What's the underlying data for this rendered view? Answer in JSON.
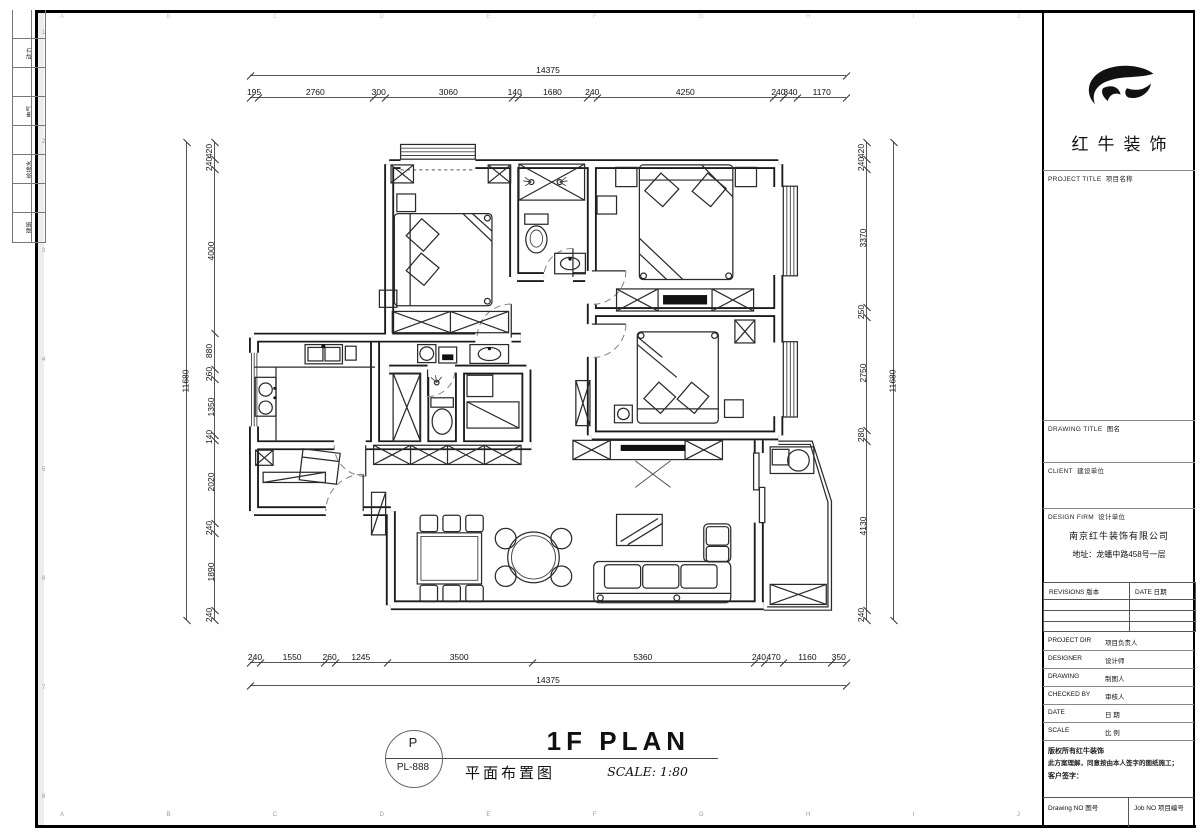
{
  "sheet": {
    "margin_rows": [
      "",
      "动力",
      "",
      "电气",
      "",
      "给排水",
      "",
      "建筑"
    ],
    "bottom_ruler_letters": [
      "A",
      "B",
      "C",
      "D",
      "E",
      "F",
      "G",
      "H",
      "I",
      "J"
    ],
    "top_ruler_letters": [
      "A",
      "B",
      "C",
      "D",
      "E",
      "F",
      "G",
      "H",
      "I",
      "J"
    ],
    "left_ruler_numbers": [
      "1",
      "2",
      "3",
      "4",
      "5",
      "6",
      "7",
      "8"
    ]
  },
  "dimensions": {
    "top": {
      "segments": [
        "195",
        "2760",
        "300",
        "3060",
        "140",
        "1680",
        "240",
        "4250",
        "240",
        "340",
        "1170"
      ],
      "total": [
        "14375"
      ]
    },
    "bottom": {
      "segments": [
        "240",
        "1550",
        "260",
        "1245",
        "3500",
        "5360",
        "240",
        "470",
        "1160",
        "350"
      ],
      "total": [
        "14375"
      ]
    },
    "left": {
      "segments": [
        "420",
        "240",
        "4000",
        "880",
        "260",
        "1350",
        "140",
        "2020",
        "240",
        "1890",
        "240"
      ],
      "total": [
        "11680"
      ]
    },
    "right": {
      "segments": [
        "420",
        "240",
        "3370",
        "250",
        "2750",
        "280",
        "4130",
        "240"
      ],
      "total": [
        "11680"
      ]
    }
  },
  "caption": {
    "code_letter": "P",
    "code": "PL-888",
    "title_en": "1F PLAN",
    "title_cn": "平面布置图",
    "scale": "SCALE: 1:80"
  },
  "titleblock": {
    "brand": "红牛装饰",
    "project_title_en": "PROJECT TITLE",
    "project_title_cn": "项目名称",
    "drawing_title_en": "DRAWING TITLE",
    "drawing_title_cn": "图名",
    "client_en": "CLIENT",
    "client_cn": "建设单位",
    "design_firm_en": "DESIGN FIRM",
    "design_firm_cn": "设计单位",
    "company": "南京红牛装饰有限公司",
    "address": "地址：龙蟠中路458号一层",
    "revisions_en": "REVISIONS",
    "revisions_cn": "版本",
    "date_col_en": "DATE",
    "date_col_cn": "日期",
    "rows": [
      {
        "en": "PROJECT DIR",
        "cn": "项目负责人"
      },
      {
        "en": "DESIGNER",
        "cn": "设计师"
      },
      {
        "en": "DRAWING",
        "cn": "制图人"
      },
      {
        "en": "CHECKED BY",
        "cn": "审核人"
      },
      {
        "en": "DATE",
        "cn": "日  期"
      },
      {
        "en": "SCALE",
        "cn": "比  例"
      }
    ],
    "copyright_line1": "版权所有红牛装饰",
    "copyright_line2": "此方案理解，同意按由本人签字的图纸施工；",
    "copyright_line3": "客户签字：",
    "drawing_no_en": "Drawing NO",
    "drawing_no_cn": "图号",
    "job_no_en": "Job NO",
    "job_no_cn": "项目编号"
  }
}
